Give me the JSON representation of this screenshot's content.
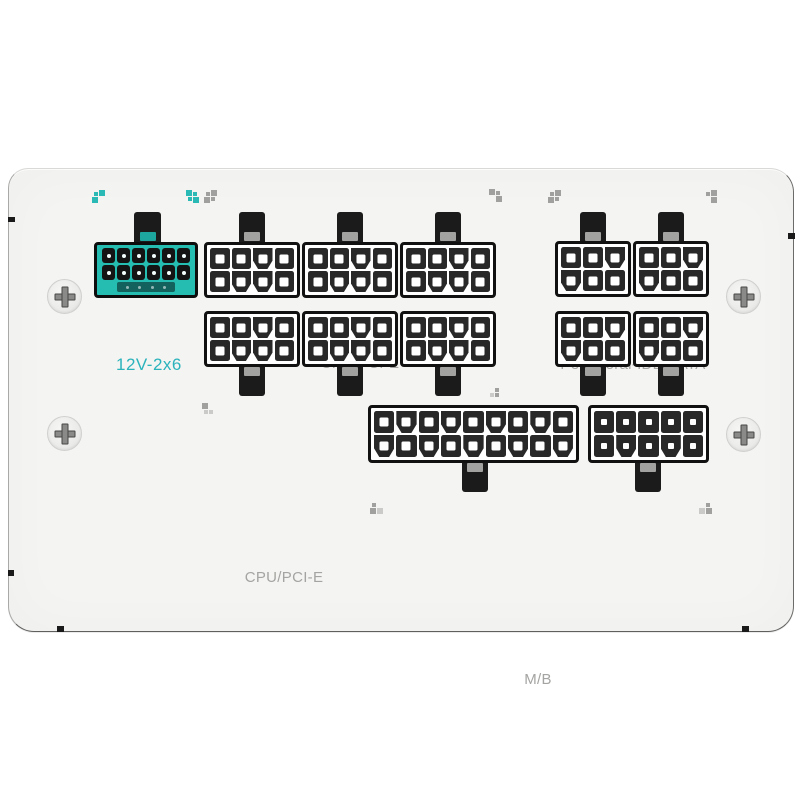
{
  "product": "white modular PSU connector panel",
  "colors": {
    "accent_teal": "#25bcb2",
    "label_teal": "#2bb3bc",
    "label_gray": "#a4a4a2",
    "panel_bg": "#f4f4f2"
  },
  "labels": {
    "v12": "12V-2x6",
    "cpu_top": "CPU/PCI-E",
    "peripheral": "Peripheral-IDE/SATA",
    "cpu_mid": "CPU/PCI-E",
    "mb": "M/B"
  },
  "connectors": [
    {
      "id": "12v-2x6",
      "group": "12V-2x6",
      "style": "teal",
      "tab": "top",
      "notch": "teal",
      "hole": "dot",
      "rows": [
        "ssssss",
        "ssssss"
      ],
      "sense_pins": 4,
      "pin_count": 12
    },
    {
      "id": "cpu-top-1",
      "group": "CPU/PCI-E",
      "style": "dark",
      "tab": "top",
      "notch": "gray",
      "hole": "square",
      "rows": [
        "sscs",
        "sccs"
      ],
      "pin_count": 8
    },
    {
      "id": "cpu-top-2",
      "group": "CPU/PCI-E",
      "style": "dark",
      "tab": "top",
      "notch": "gray",
      "hole": "square",
      "rows": [
        "sscs",
        "sccs"
      ],
      "pin_count": 8
    },
    {
      "id": "cpu-top-3",
      "group": "CPU/PCI-E",
      "style": "dark",
      "tab": "top",
      "notch": "gray",
      "hole": "square",
      "rows": [
        "sscs",
        "sccs"
      ],
      "pin_count": 8
    },
    {
      "id": "peri-top-1",
      "group": "Peripheral-IDE/SATA",
      "style": "dark",
      "tab": "top",
      "notch": "gray",
      "hole": "square",
      "rows": [
        "ssc",
        "css"
      ],
      "pin_count": 6
    },
    {
      "id": "peri-top-2",
      "group": "Peripheral-IDE/SATA",
      "style": "dark",
      "tab": "top",
      "notch": "gray",
      "hole": "square",
      "rows": [
        "ssc",
        "css"
      ],
      "pin_count": 6
    },
    {
      "id": "cpu-mid-1",
      "group": "CPU/PCI-E",
      "style": "dark",
      "tab": "bottom",
      "notch": "gray",
      "hole": "square",
      "rows": [
        "sscs",
        "sccs"
      ],
      "pin_count": 8
    },
    {
      "id": "cpu-mid-2",
      "group": "CPU/PCI-E",
      "style": "dark",
      "tab": "bottom",
      "notch": "gray",
      "hole": "square",
      "rows": [
        "sscs",
        "sccs"
      ],
      "pin_count": 8
    },
    {
      "id": "cpu-mid-3",
      "group": "CPU/PCI-E",
      "style": "dark",
      "tab": "bottom",
      "notch": "gray",
      "hole": "square",
      "rows": [
        "sscs",
        "sccs"
      ],
      "pin_count": 8
    },
    {
      "id": "peri-mid-1",
      "group": "Peripheral-IDE/SATA",
      "style": "dark",
      "tab": "bottom",
      "notch": "gray",
      "hole": "square",
      "rows": [
        "ssc",
        "css"
      ],
      "pin_count": 6
    },
    {
      "id": "peri-mid-2",
      "group": "Peripheral-IDE/SATA",
      "style": "dark",
      "tab": "bottom",
      "notch": "gray",
      "hole": "square",
      "rows": [
        "ssc",
        "css"
      ],
      "pin_count": 6
    },
    {
      "id": "mb-18pin",
      "group": "M/B",
      "style": "dark",
      "tab": "bottom",
      "notch": "gray",
      "hole": "square",
      "rows": [
        "scscscscs",
        "cscscscsc"
      ],
      "pin_count": 18
    },
    {
      "id": "mb-10pin",
      "group": "M/B",
      "style": "dark",
      "tab": "bottom",
      "notch": "gray",
      "hole": "small",
      "rows": [
        "sssss",
        "scscs"
      ],
      "pin_count": 10
    }
  ],
  "markers": [
    {
      "id": "m-12v-left",
      "color": "teal",
      "cells": [
        1,
        2,
        2,
        0
      ]
    },
    {
      "id": "m-12v-right-1",
      "color": "teal",
      "cells": [
        2,
        1,
        1,
        2
      ]
    },
    {
      "id": "m-12v-right-2",
      "color": "gray",
      "cells": [
        1,
        2,
        2,
        1
      ]
    },
    {
      "id": "m-cpu-top",
      "color": "gray",
      "cells": [
        2,
        1,
        0,
        2
      ]
    },
    {
      "id": "m-peri-left",
      "color": "gray",
      "cells": [
        1,
        2,
        2,
        1
      ]
    },
    {
      "id": "m-peri-right",
      "color": "gray",
      "cells": [
        1,
        2,
        0,
        2
      ]
    },
    {
      "id": "m-cpu-mid",
      "color": "gray",
      "cells": [
        2,
        0,
        4,
        4
      ]
    },
    {
      "id": "m-row2-right",
      "color": "gray",
      "cells": [
        0,
        1,
        4,
        1
      ]
    },
    {
      "id": "m-mb-left",
      "color": "gray",
      "cells": [
        1,
        0,
        2,
        3
      ]
    },
    {
      "id": "m-mb-right",
      "color": "gray",
      "cells": [
        0,
        1,
        3,
        2
      ]
    }
  ],
  "screws": [
    {
      "id": "screw-top-left"
    },
    {
      "id": "screw-bottom-left"
    },
    {
      "id": "screw-top-right"
    },
    {
      "id": "screw-bottom-right"
    }
  ]
}
